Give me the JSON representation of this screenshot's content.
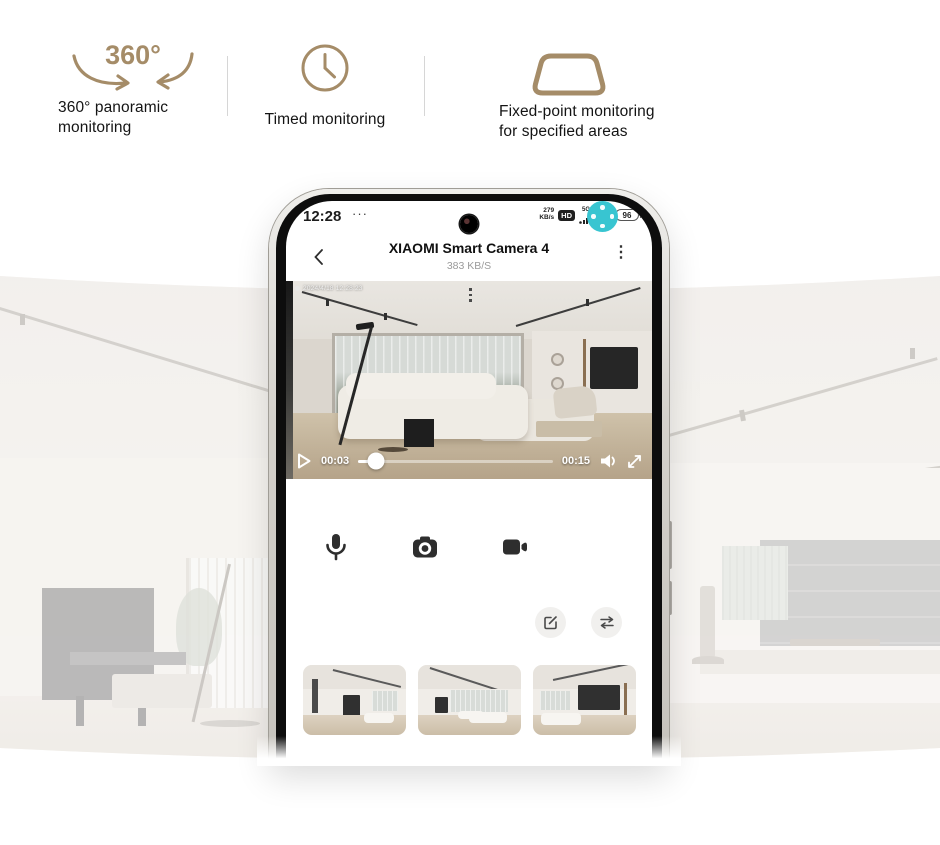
{
  "colors": {
    "accent_tan": "#a58c68",
    "teal_button": "#38c5d1",
    "badge_dark": "#1f1f1f"
  },
  "features": [
    {
      "icon": "rotate-360-icon",
      "icon_text": "360°",
      "line1": "360° panoramic",
      "line2": "monitoring"
    },
    {
      "icon": "clock-icon",
      "line1": "Timed monitoring"
    },
    {
      "icon": "trapezoid-icon",
      "line1": "Fixed-point monitoring",
      "line2": "for specified areas"
    }
  ],
  "phone": {
    "status_bar": {
      "time": "12:28",
      "more_dots": "···",
      "net_speed_value": "279",
      "net_speed_unit": "KB/s",
      "hd_badge": "HD",
      "sim1_label": "5G",
      "sim2_label": "5GA",
      "battery_percent": "96"
    },
    "app_bar": {
      "title": "XIAOMI Smart Camera 4",
      "subtitle": "383 KB/S",
      "menu_icon": "⋮"
    },
    "player": {
      "osd_timestamp": "2024/4/18 12:28:23",
      "elapsed": "00:03",
      "duration": "00:15",
      "progress_percent": 9
    }
  }
}
